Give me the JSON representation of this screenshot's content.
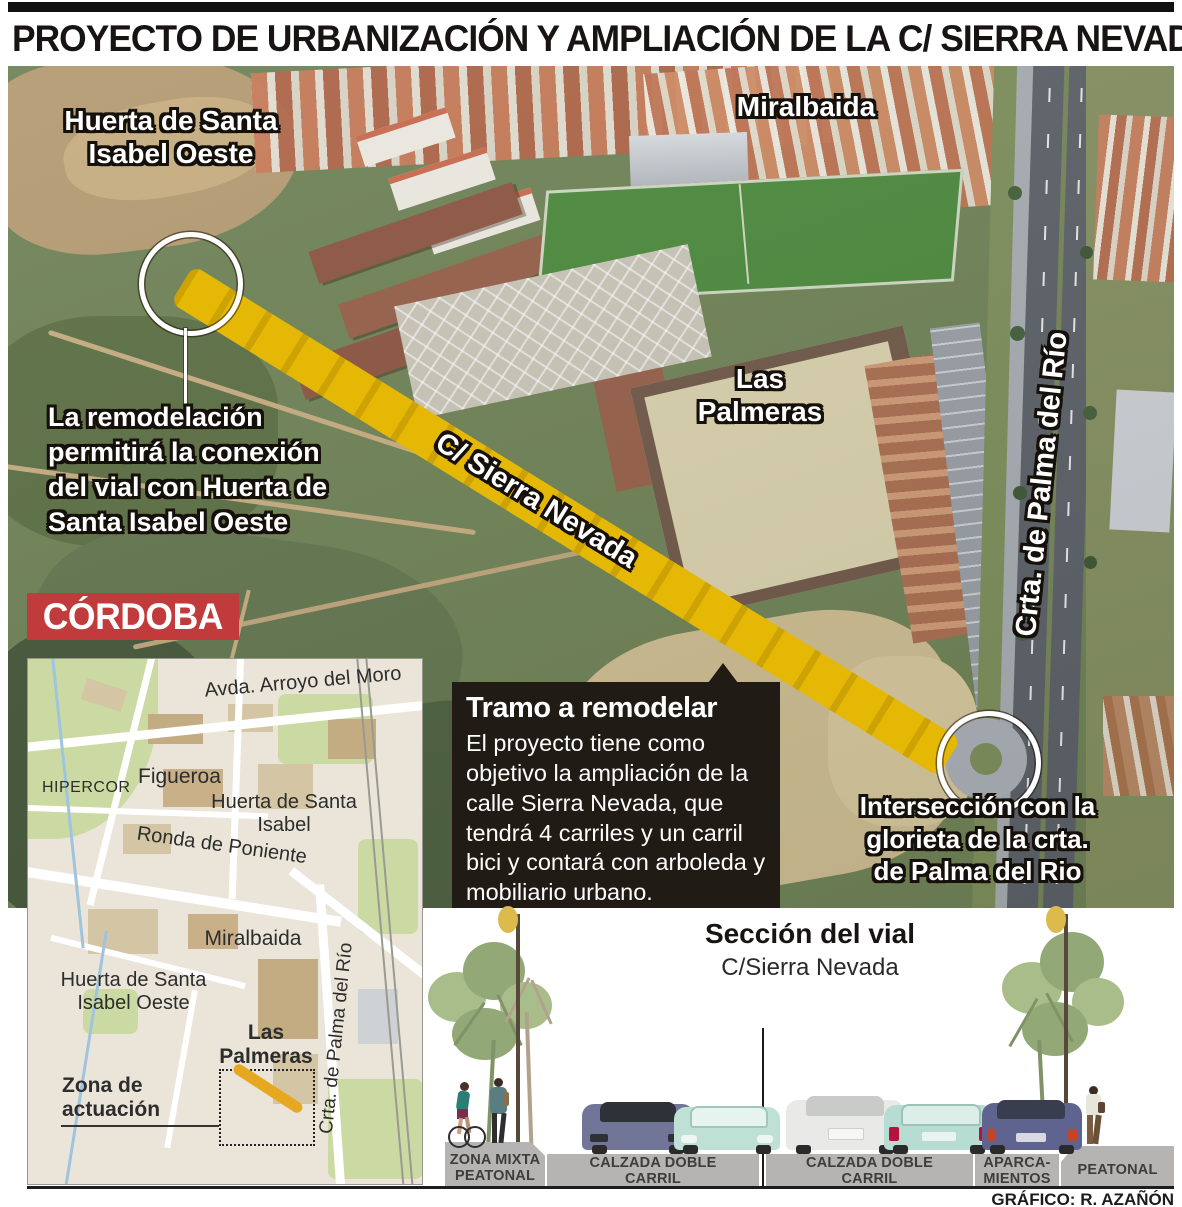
{
  "header": {
    "title": "PROYECTO DE URBANIZACIÓN Y AMPLIACIÓN DE LA C/ SIERRA NEVADA"
  },
  "aerial": {
    "labels": {
      "huerta_oeste": "Huerta de Santa Isabel Oeste",
      "miralbaida": "Miralbaida",
      "las_palmeras": "Las Palmeras",
      "sierra_nevada": "C/ Sierra Nevada",
      "palma_del_rio": "Crta. de Palma del Río"
    },
    "annotation_left": "La remodelación permitirá la conexión del vial con Huerta de Santa Isabel Oeste",
    "annotation_right": "Intersección con la glorieta de la crta. de Palma del Rio",
    "brand": "CÓRDOBA",
    "callout": {
      "title": "Tramo a remodelar",
      "body": "El proyecto tiene como objetivo la ampliación de la calle Sierra Nevada, que tendrá 4 carriles y un carril bici y contará con arboleda y mobiliario urbano."
    }
  },
  "map": {
    "labels": {
      "arroyo_del_moro": "Avda. Arroyo del Moro",
      "hipercor": "HIPERCOR",
      "figueroa": "Figueroa",
      "huerta_santa_isabel": "Huerta de Santa Isabel",
      "ronda_poniente": "Ronda de Poniente",
      "miralbaida": "Miralbaida",
      "huerta_oeste": "Huerta de Santa Isabel Oeste",
      "las_palmeras": "Las Palmeras",
      "zona_actuacion": "Zona de actuación",
      "palma_del_rio": "Crta. de Palma del Río"
    }
  },
  "section": {
    "title": "Sección del vial",
    "subtitle": "C/Sierra Nevada",
    "zones": [
      {
        "label": "ZONA MIXTA PEATONAL"
      },
      {
        "label": "CALZADA DOBLE CARRIL"
      },
      {
        "label": "CALZADA DOBLE CARRIL"
      },
      {
        "label": "APARCA-MIENTOS"
      },
      {
        "label": "PEATONAL"
      }
    ]
  },
  "credit": "GRÁFICO: R. AZAÑÓN",
  "colors": {
    "highlight_road": "#e5b805",
    "brand_red": "#c23b3c",
    "callout_bg": "#211b15",
    "map_actuation_stroke": "#e7a821",
    "platform_gray": "#b5b4b2"
  }
}
